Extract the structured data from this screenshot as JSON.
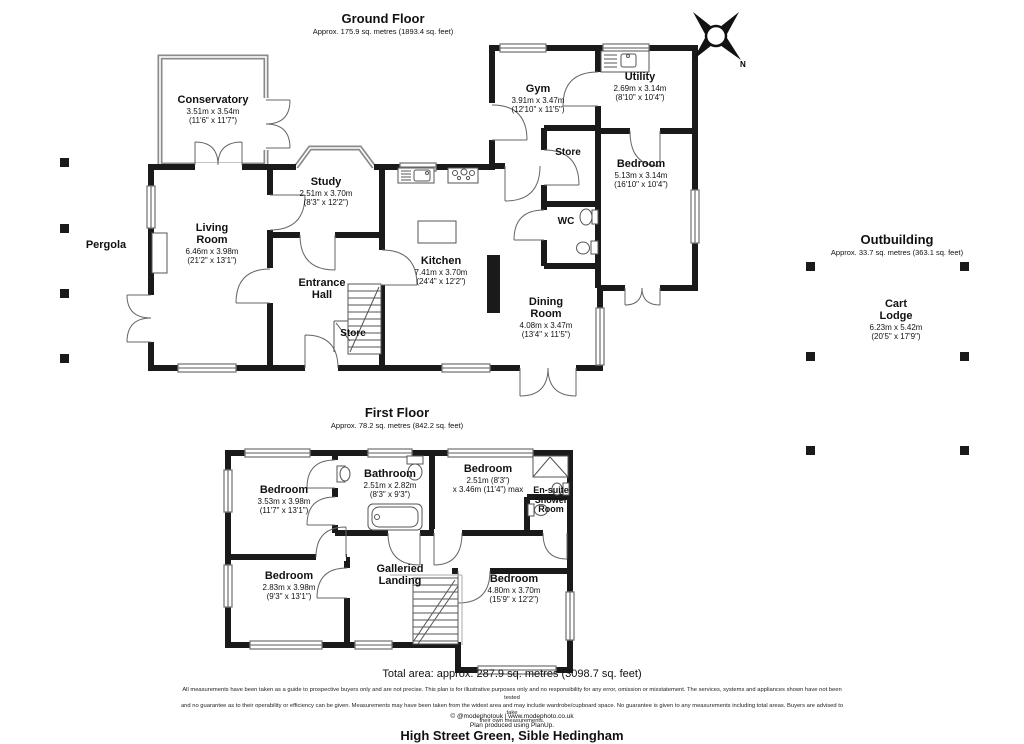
{
  "header": {
    "ground_title": "Ground Floor",
    "ground_subtitle": "Approx. 175.9 sq. metres (1893.4 sq. feet)",
    "first_title": "First Floor",
    "first_subtitle": "Approx. 78.2 sq. metres (842.2 sq. feet)",
    "outbuilding_title": "Outbuilding",
    "outbuilding_subtitle": "Approx. 33.7 sq. metres (363.1 sq. feet)"
  },
  "compass": {
    "label": "N"
  },
  "rooms": {
    "conservatory": {
      "name": "Conservatory",
      "dims_m": "3.51m x 3.54m",
      "dims_ft": "(11'6\" x 11'7\")"
    },
    "study": {
      "name": "Study",
      "dims_m": "2.51m x 3.70m",
      "dims_ft": "(8'3\" x 12'2\")"
    },
    "living_room": {
      "name": "Living Room",
      "dims_m": "6.46m x 3.98m",
      "dims_ft": "(21'2\" x 13'1\")"
    },
    "pergola": {
      "name": "Pergola"
    },
    "entrance_hall": {
      "name": "Entrance Hall"
    },
    "store_hall": {
      "name": "Store"
    },
    "kitchen": {
      "name": "Kitchen",
      "dims_m": "7.41m x 3.70m",
      "dims_ft": "(24'4\" x 12'2\")"
    },
    "gym": {
      "name": "Gym",
      "dims_m": "3.91m x 3.47m",
      "dims_ft": "(12'10\" x 11'5\")"
    },
    "utility": {
      "name": "Utility",
      "dims_m": "2.69m x 3.14m",
      "dims_ft": "(8'10\" x 10'4\")"
    },
    "store_rear": {
      "name": "Store"
    },
    "bedroom_ground": {
      "name": "Bedroom",
      "dims_m": "5.13m x 3.14m",
      "dims_ft": "(16'10\" x 10'4\")"
    },
    "wc": {
      "name": "WC"
    },
    "dining_room": {
      "name": "Dining Room",
      "dims_m": "4.08m x 3.47m",
      "dims_ft": "(13'4\" x 11'5\")"
    },
    "cart_lodge": {
      "name": "Cart Lodge",
      "dims_m": "6.23m x 5.42m",
      "dims_ft": "(20'5\" x 17'9\")"
    },
    "bedroom_ff_front": {
      "name": "Bedroom",
      "dims_m": "3.53m x 3.98m",
      "dims_ft": "(11'7\" x 13'1\")"
    },
    "bathroom": {
      "name": "Bathroom",
      "dims_m": "2.51m x 2.82m",
      "dims_ft": "(8'3\" x 9'3\")"
    },
    "bedroom_ff_middle": {
      "name": "Bedroom",
      "dims_m": "2.51m (8'3\")",
      "dims_ft": "x 3.46m (11'4\") max"
    },
    "ensuite": {
      "name": "En-suite Shower Room"
    },
    "bedroom_ff_left": {
      "name": "Bedroom",
      "dims_m": "2.83m x 3.98m",
      "dims_ft": "(9'3\" x 13'1\")"
    },
    "galleried_landing": {
      "name": "Galleried Landing"
    },
    "bedroom_ff_right": {
      "name": "Bedroom",
      "dims_m": "4.80m x 3.70m",
      "dims_ft": "(15'9\" x 12'2\")"
    }
  },
  "footer": {
    "total_area": "Total area: approx. 287.9 sq. metres (3098.7 sq. feet)",
    "disclaimer_line1": "All measurements have been taken as a guide to prospective buyers only and are not precise. This plan is for illustrative purposes only and no responsibility for any error, omission or misstatement. The services, systems and appliances shown have not been tested",
    "disclaimer_line2": "and no guarantee as to their operability or efficiency can be given. Measurements may have been taken from the widest area and may include wardrobe/cupboard space. No guarantee is given to any measurements including total areas. Buyers are advised to take",
    "disclaimer_line3": "their own measurements.",
    "credit": "© @modephotouk | www.modephoto.co.uk",
    "software": "Plan produced using PlanUp.",
    "address": "High Street Green, Sible Hedingham"
  },
  "colors": {
    "wall": "#1a1a1a",
    "window": "#7a7a7a",
    "fixture": "#555555"
  }
}
